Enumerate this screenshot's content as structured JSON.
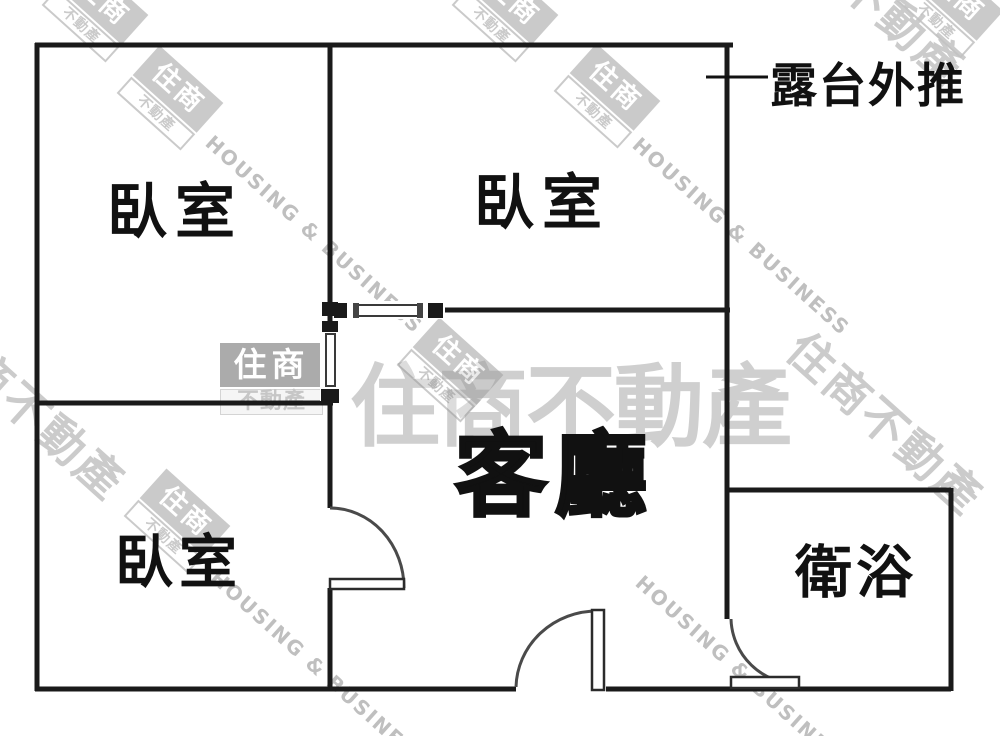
{
  "floorplan": {
    "rooms": [
      {
        "id": "bedroom-top-left",
        "label": "臥室"
      },
      {
        "id": "bedroom-top-right",
        "label": "臥室"
      },
      {
        "id": "bedroom-bottom-left",
        "label": "臥室"
      },
      {
        "id": "living-room",
        "label": "客廳"
      },
      {
        "id": "bathroom",
        "label": "衛浴"
      }
    ],
    "annotations": [
      {
        "id": "balcony-note",
        "label": "露台外推"
      }
    ]
  },
  "watermarks": {
    "brand_cjk": "住商不動產",
    "brand_short": "住商",
    "brand_suffix": "不動產",
    "brand_en": "HOUSING & BUSINESS"
  },
  "colors": {
    "wall": "#1a1a1a",
    "door_arc": "#4a4a4a",
    "label": "#111111",
    "watermark_gray": "#a8a8a8",
    "background": "#ffffff"
  }
}
